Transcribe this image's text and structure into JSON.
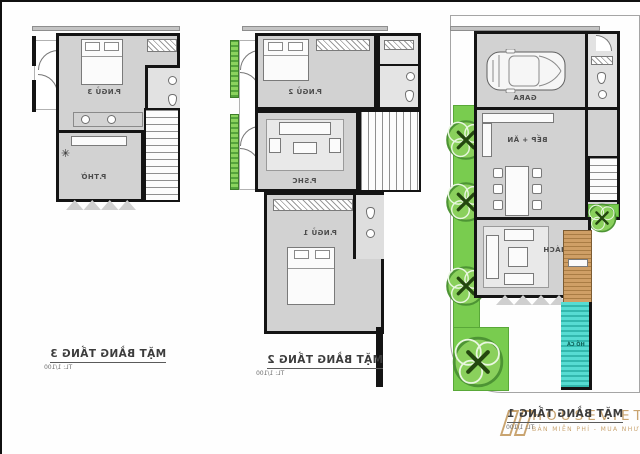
{
  "plans": [
    {
      "caption": "MẶT BẰNG TẦNG 3",
      "scale": "TL: 1/100",
      "rooms": [
        "P.NGỦ 3",
        "P.THỜ"
      ]
    },
    {
      "caption": "MẶT BẰNG TẦNG 2",
      "scale": "TL: 1/100",
      "rooms": [
        "P.NGỦ 2",
        "P.SHC",
        "P.NGỦ 1"
      ]
    },
    {
      "caption": "MẶT BẰNG TẦNG 1",
      "scale": "TL: 1/100",
      "rooms": [
        "GARA",
        "BẾP + ĂN",
        "P.KHÁCH",
        "HỒ CÁ"
      ]
    }
  ],
  "watermark": {
    "brand": "HOUSEVIET",
    "tagline": "BẢN MIỄN PHÍ - MUA NHƯ Ý"
  },
  "icons": {
    "fan": "✳",
    "tree_mark": "✕"
  },
  "colors": {
    "wall": "#141414",
    "floor": "#d2d2d2",
    "grass": "#79cc4f",
    "pool": "#4ed7cb",
    "deck": "#c89a63",
    "logo": "#c9a470"
  }
}
